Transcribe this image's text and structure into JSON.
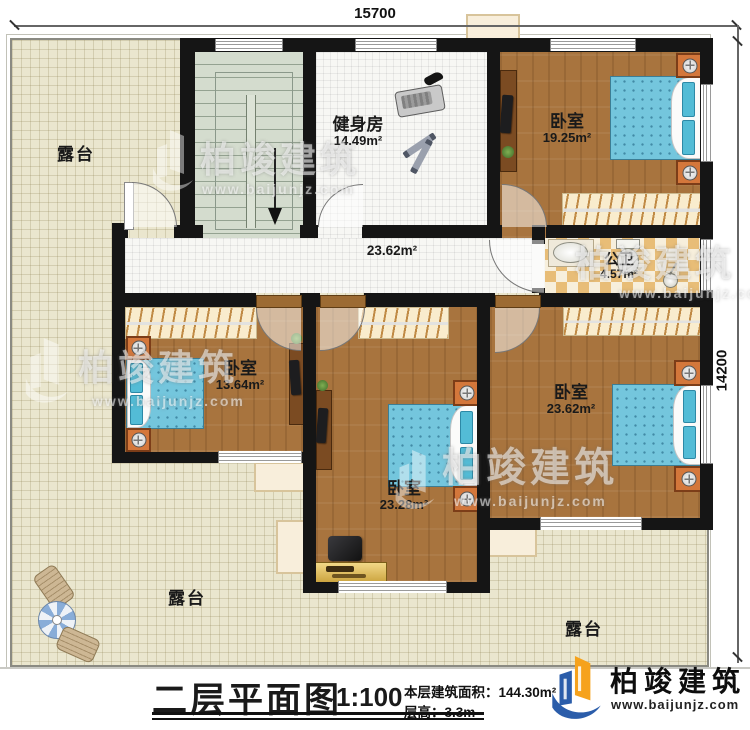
{
  "dimensions": {
    "width": "15700",
    "height": "14200"
  },
  "rooms": {
    "gym": {
      "name": "健身房",
      "area": "14.49m²"
    },
    "bedroom_top_right": {
      "name": "卧室",
      "area": "19.25m²"
    },
    "bathroom": {
      "name": "公卫",
      "area": "4.57m²"
    },
    "bedroom_left": {
      "name": "卧室",
      "area": "13.64m²"
    },
    "bedroom_center": {
      "name": "卧室",
      "area": "23.28m²"
    },
    "bedroom_right": {
      "name": "卧室",
      "area": "23.62m²"
    },
    "corridor": {
      "area": "23.62m²"
    }
  },
  "terrace": {
    "label": "露台"
  },
  "watermark": {
    "name": "柏竣建筑",
    "website": "www.baijunjz.com"
  },
  "title_block": {
    "title": "二层平面图",
    "scale": "1:100",
    "area_label": "本层建筑面积：",
    "area_value": "144.30m²",
    "height_label": "层高：",
    "height_value": "3.3m"
  },
  "brand": {
    "name": "柏竣建筑",
    "website": "www.baijunjz.com",
    "blue": "#2b5daa",
    "orange": "#f6a21c"
  },
  "palette": {
    "wall": "#151515",
    "wood_floor": "#a8743e",
    "terrace_floor": "#eae6ce",
    "stair_floor": "#d4dcce",
    "bath_tile": "#e8bd77",
    "bed_blue": "#74c6dd"
  }
}
